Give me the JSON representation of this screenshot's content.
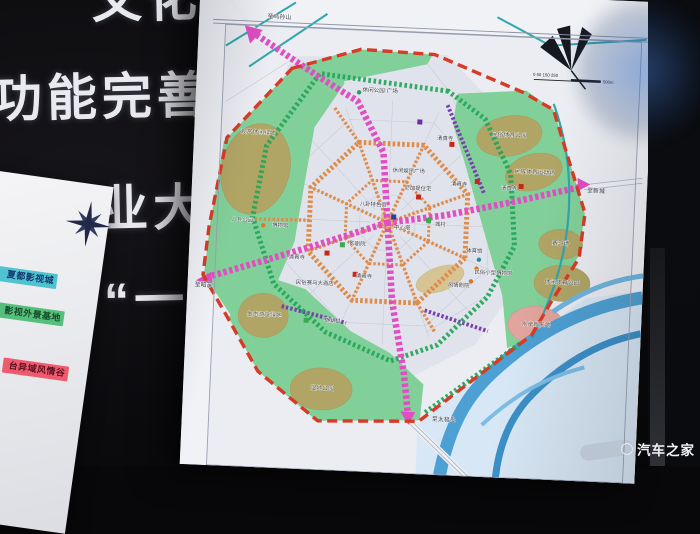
{
  "slide": {
    "top_fragment": "文化优",
    "lines": [
      "功能完善、",
      "化产业大发",
      "位为“一核"
    ]
  },
  "legend": {
    "items": [
      {
        "label": "夏都影视城",
        "bg": "#4fc3d0",
        "fg": "#14386e"
      },
      {
        "label": "影视外景基地",
        "bg": "#55c07c",
        "fg": "#174a2a"
      },
      {
        "label": "台异域风情谷",
        "bg": "#ee5b6e",
        "fg": "#5e1020"
      }
    ]
  },
  "watermark": "汽车之家",
  "map": {
    "title_fragment": "规划图",
    "scale": {
      "ticks": "0  50 150 250",
      "unit": "500m"
    },
    "colors": {
      "boundary_red": "#d93a26",
      "main_axis_magenta": "#e14dc2",
      "ring_orange": "#df8b4a",
      "greenway": "#22a558",
      "secondary_purple": "#7a3fae",
      "park_green": "#82d099",
      "park_olive": "#b1a565",
      "river_blue": "#4da0d3",
      "mosque_red": "#cc2418",
      "village_green": "#3aa94f"
    },
    "labels": [
      {
        "t": "至乌孙山",
        "x": 80,
        "y": 33,
        "s": 6
      },
      {
        "t": "休闲公园·广场",
        "x": 184,
        "y": 102,
        "s": 5.6
      },
      {
        "t": "观赏休闲绿地",
        "x": 64,
        "y": 149,
        "s": 5.8,
        "c": "#4c4a33"
      },
      {
        "t": "民俗体育公园",
        "x": 315,
        "y": 141,
        "s": 5.8,
        "c": "#4c4a33"
      },
      {
        "t": "民族体育运动场",
        "x": 342,
        "y": 177,
        "s": 5.8,
        "c": "#4c4a33"
      },
      {
        "t": "清真寺",
        "x": 251,
        "y": 147,
        "s": 5.4
      },
      {
        "t": "休闲娱乐广场",
        "x": 216,
        "y": 181,
        "s": 5.4
      },
      {
        "t": "尼加提住宅",
        "x": 226,
        "y": 198,
        "s": 5.4
      },
      {
        "t": "清真寺",
        "x": 267,
        "y": 192,
        "s": 5.4
      },
      {
        "t": "清真寺",
        "x": 317,
        "y": 194,
        "s": 5.4
      },
      {
        "t": "八卦特色街",
        "x": 182,
        "y": 216,
        "s": 5.4
      },
      {
        "t": "中心塔",
        "x": 212,
        "y": 238,
        "s": 5.4
      },
      {
        "t": "城村",
        "x": 250,
        "y": 233,
        "s": 5.4
      },
      {
        "t": "八卦公园",
        "x": 52,
        "y": 237,
        "s": 5.4
      },
      {
        "t": "博物馆",
        "x": 90,
        "y": 241,
        "s": 5.4
      },
      {
        "t": "影剧院",
        "x": 168,
        "y": 256,
        "s": 5.4
      },
      {
        "t": "清真寺",
        "x": 108,
        "y": 272,
        "s": 5.4
      },
      {
        "t": "清真寺",
        "x": 176,
        "y": 288,
        "s": 5.4
      },
      {
        "t": "民俗赛马大酒店",
        "x": 127,
        "y": 297,
        "s": 5.4
      },
      {
        "t": "体育馆",
        "x": 285,
        "y": 258,
        "s": 5.4
      },
      {
        "t": "民俗小型博物馆",
        "x": 305,
        "y": 279,
        "s": 5.4
      },
      {
        "t": "风情剧院",
        "x": 271,
        "y": 293,
        "s": 5.4
      },
      {
        "t": "赛马场",
        "x": 371,
        "y": 247,
        "s": 5.8,
        "c": "#4c4a33"
      },
      {
        "t": "休闲体育公园",
        "x": 374,
        "y": 286,
        "s": 5.8,
        "c": "#4c4a33"
      },
      {
        "t": "水岸新天地",
        "x": 350,
        "y": 329,
        "s": 5.8,
        "c": "#6b3c35"
      },
      {
        "t": "生态游览绿地",
        "x": 78,
        "y": 331,
        "s": 5.8,
        "c": "#4c4a33"
      },
      {
        "t": "草湖村",
        "x": 146,
        "y": 334,
        "s": 5.4
      },
      {
        "t": "湿地公园",
        "x": 139,
        "y": 402,
        "s": 5.8,
        "c": "#4c4a33"
      },
      {
        "t": "至新城",
        "x": 404,
        "y": 193,
        "s": 6
      },
      {
        "t": "至昭苏",
        "x": 16,
        "y": 304,
        "s": 6
      },
      {
        "t": "至太极岛",
        "x": 262,
        "y": 428,
        "s": 6
      }
    ],
    "markers": [
      {
        "c": "#cc2418",
        "x": 227,
        "y": 205,
        "sh": "sq"
      },
      {
        "c": "#cc2418",
        "x": 285,
        "y": 187,
        "sh": "sq"
      },
      {
        "c": "#cc2418",
        "x": 329,
        "y": 190,
        "sh": "sq"
      },
      {
        "c": "#cc2418",
        "x": 258,
        "y": 151,
        "sh": "sq"
      },
      {
        "c": "#cc2418",
        "x": 138,
        "y": 265,
        "sh": "sq"
      },
      {
        "c": "#cc2418",
        "x": 167,
        "y": 285,
        "sh": "sq"
      },
      {
        "c": "#3aa94f",
        "x": 153,
        "y": 256,
        "sh": "sq"
      },
      {
        "c": "#3aa94f",
        "x": 238,
        "y": 228,
        "sh": "sq"
      },
      {
        "c": "#3aa94f",
        "x": 120,
        "y": 333,
        "sh": "sq"
      },
      {
        "c": "#6a2fa0",
        "x": 225,
        "y": 130,
        "sh": "sq"
      },
      {
        "c": "#2b3f9e",
        "x": 203,
        "y": 226,
        "sh": "sq"
      },
      {
        "c": "#1f8f96",
        "x": 290,
        "y": 265,
        "sh": "dot"
      },
      {
        "c": "#d8762a",
        "x": 288,
        "y": 274,
        "sh": "dot"
      },
      {
        "c": "#d8762a",
        "x": 283,
        "y": 287,
        "sh": "dot"
      },
      {
        "c": "#d8762a",
        "x": 73,
        "y": 240,
        "sh": "dot"
      },
      {
        "c": "#2a9f53",
        "x": 163,
        "y": 103,
        "sh": "dot"
      }
    ]
  }
}
